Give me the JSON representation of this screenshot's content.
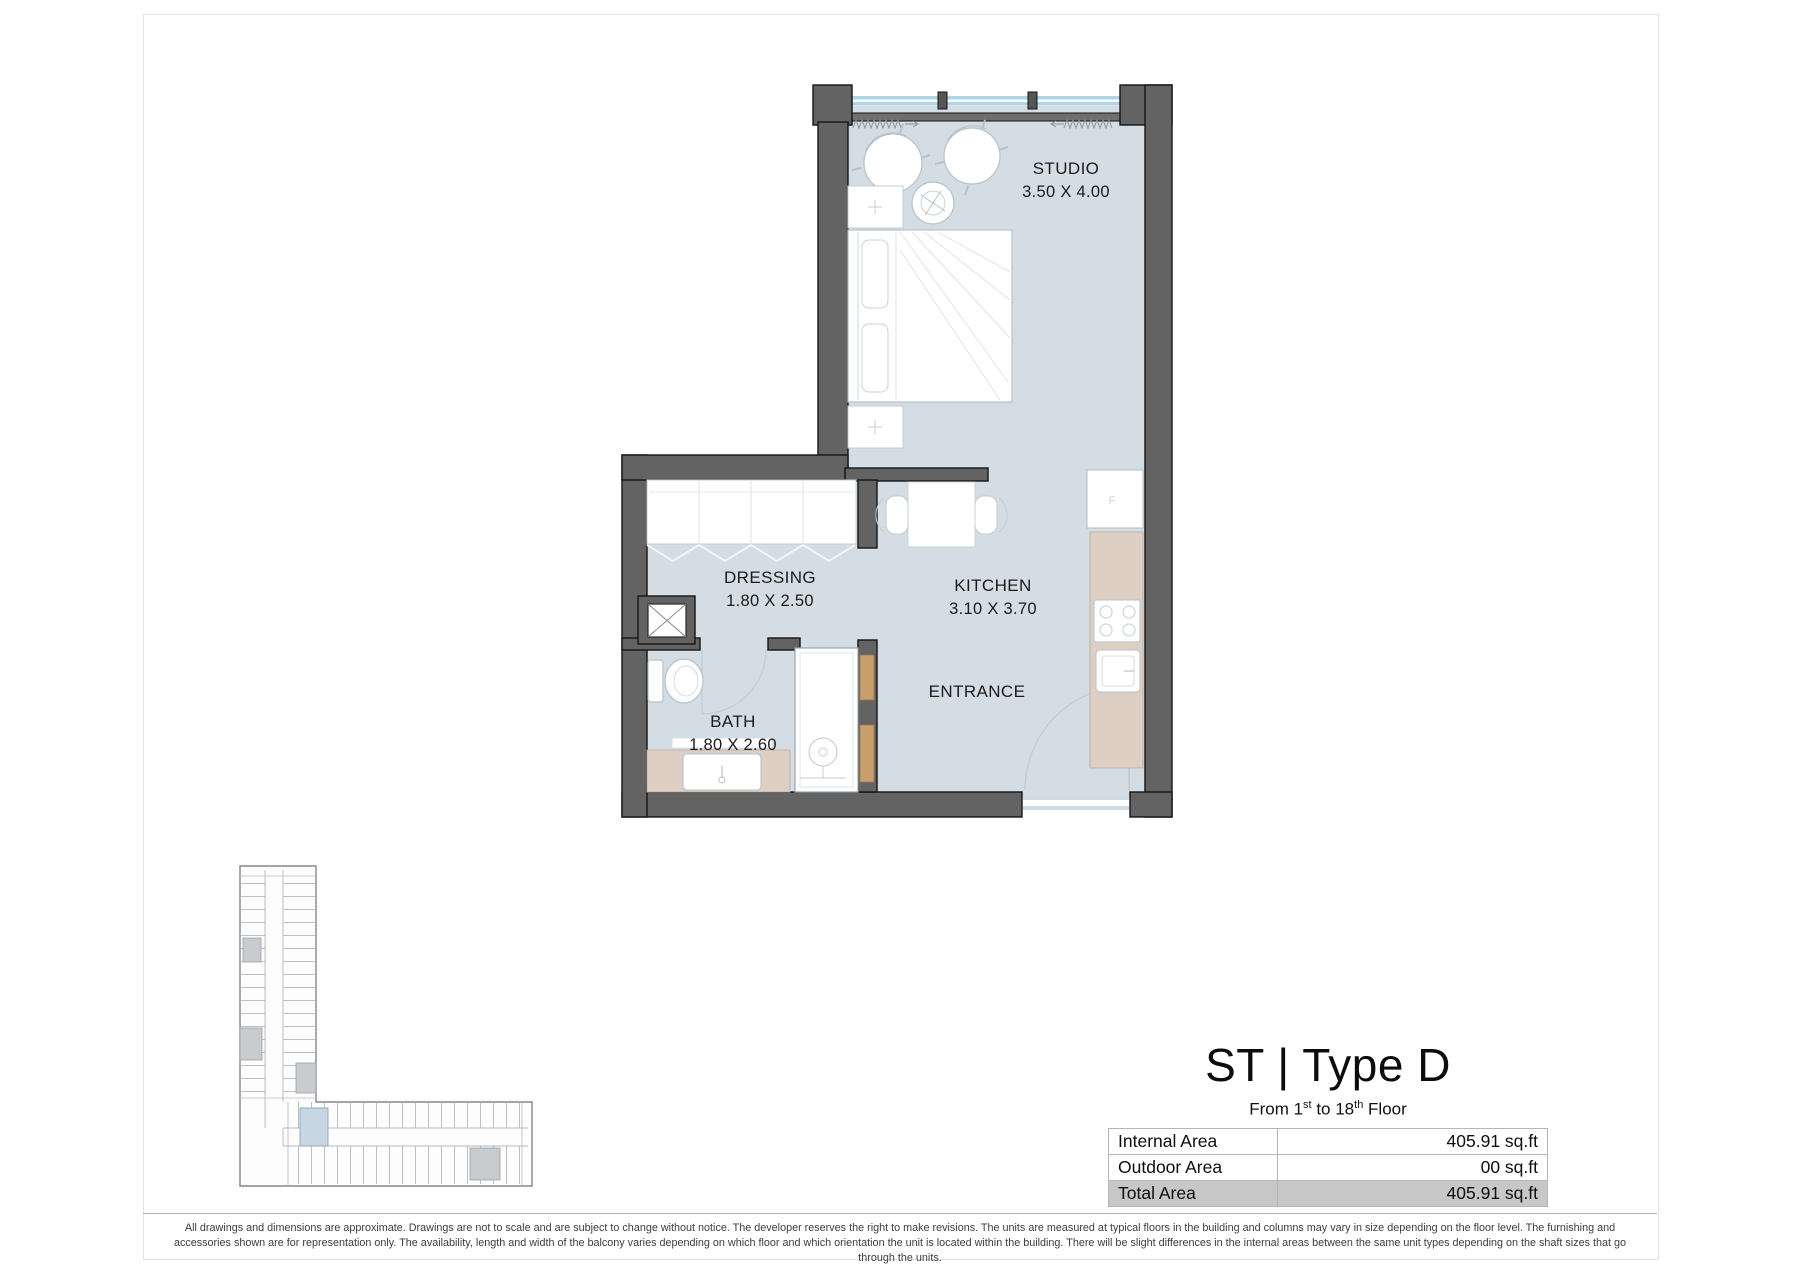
{
  "unit": {
    "title": "ST | Type D",
    "floor_range": {
      "prefix": "From 1",
      "sup1": "st",
      "mid": " to 18",
      "sup2": "th",
      "suffix": " Floor"
    }
  },
  "rooms": {
    "studio": {
      "label": "STUDIO",
      "dims": "3.50 X 4.00"
    },
    "dressing": {
      "label": "DRESSING",
      "dims": "1.80 X 2.50"
    },
    "kitchen": {
      "label": "KITCHEN",
      "dims": "3.10 X 3.70"
    },
    "bath": {
      "label": "BATH",
      "dims": "1.80 X 2.60"
    },
    "entrance": {
      "label": "ENTRANCE"
    }
  },
  "area_table": {
    "rows": [
      {
        "label": "Internal Area",
        "value": "405.91 sq.ft"
      },
      {
        "label": "Outdoor Area",
        "value": "00 sq.ft"
      },
      {
        "label": "Total Area",
        "value": "405.91 sq.ft"
      }
    ]
  },
  "fridge_mark": "F",
  "disclaimer": "All drawings and dimensions are approximate. Drawings are not to scale and are subject to change without notice. The developer reserves the right to make revisions. The units are measured at typical floors in the building and columns may vary in size depending on the floor level. The furnishing and accessories shown are for representation only. The availability, length and width of the balcony varies depending on which floor and which orientation the unit is located within the building. There will be slight differences in the internal areas between the same unit types depending on the shaft sizes that go through the units.",
  "colors": {
    "wall": "#636363",
    "floor": "#d3dde3",
    "counter": "#decfc5",
    "glazing": "#aed6e8",
    "door_wood": "#c9a06b",
    "minimap_highlight": "#c6d6e2",
    "total_row_bg": "#c7c7c7"
  }
}
